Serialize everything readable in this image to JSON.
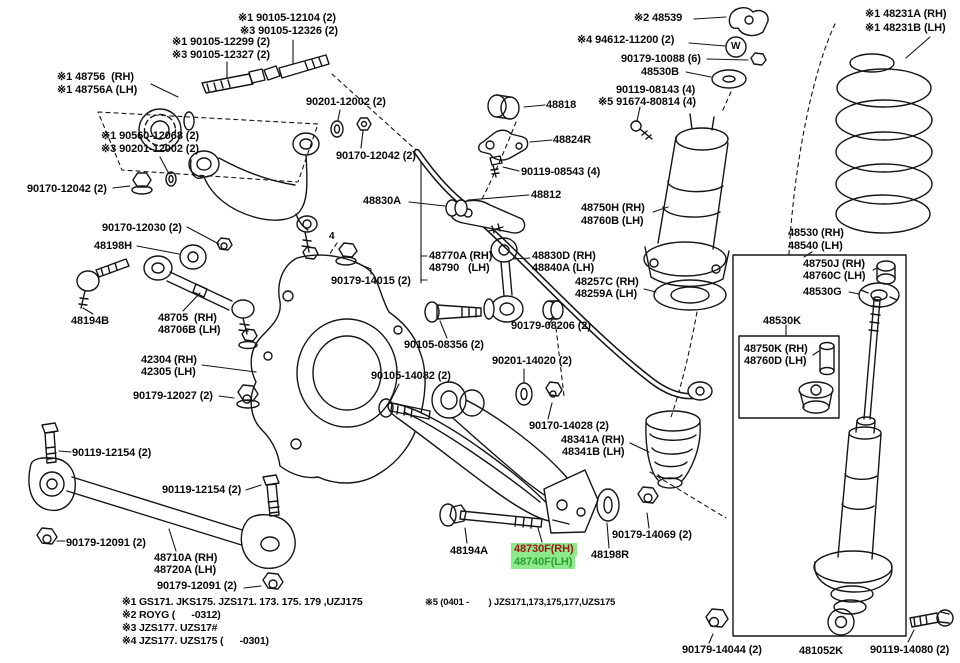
{
  "page": {
    "background": "#ffffff",
    "ink": "#151515",
    "kind": "exploded-parts-diagram",
    "subject": "rear suspension"
  },
  "highlight": {
    "bg": "#8ce98c",
    "rh_text": "#a11616",
    "lh_text": "#2f9e2f"
  },
  "labels": [
    {
      "name": "label-90105-12104",
      "text": "※1 90105-12104 (2)",
      "x": 238,
      "y": 12
    },
    {
      "name": "label-90105-12326",
      "text": "※3 90105-12326 (2)",
      "x": 240,
      "y": 25
    },
    {
      "name": "label-90105-12299",
      "text": "※1 90105-12299 (2)",
      "x": 172,
      "y": 36
    },
    {
      "name": "label-90105-12327",
      "text": "※3 90105-12327 (2)",
      "x": 172,
      "y": 49
    },
    {
      "name": "label-48756-rh",
      "text": "※1 48756  (RH)",
      "x": 57,
      "y": 71
    },
    {
      "name": "label-48756a-lh",
      "text": "※1 48756A (LH)",
      "x": 57,
      "y": 84
    },
    {
      "name": "label-90201-12002-top",
      "text": "90201-12002 (2)",
      "x": 306,
      "y": 96
    },
    {
      "name": "label-90560-12068",
      "text": "※1 90560-12068 (2)",
      "x": 101,
      "y": 130
    },
    {
      "name": "label-90201-12002-left",
      "text": "※3 90201-12002 (2)",
      "x": 101,
      "y": 143
    },
    {
      "name": "label-90170-12042-left",
      "text": "90170-12042 (2)",
      "x": 27,
      "y": 183
    },
    {
      "name": "label-90170-12042-center",
      "text": "90170-12042 (2)",
      "x": 336,
      "y": 150
    },
    {
      "name": "label-48818",
      "text": "48818",
      "x": 546,
      "y": 99
    },
    {
      "name": "label-48824r",
      "text": "48824R",
      "x": 553,
      "y": 134
    },
    {
      "name": "label-90119-08543",
      "text": "90119-08543 (4)",
      "x": 521,
      "y": 166
    },
    {
      "name": "label-48812",
      "text": "48812",
      "x": 531,
      "y": 189
    },
    {
      "name": "label-48830a",
      "text": "48830A",
      "x": 363,
      "y": 195
    },
    {
      "name": "label-48539",
      "text": "※2 48539",
      "x": 634,
      "y": 12
    },
    {
      "name": "label-94612-11200",
      "text": "※4 94612-11200 (2)",
      "x": 577,
      "y": 34
    },
    {
      "name": "label-90179-10088",
      "text": "90179-10088 (6)",
      "x": 621,
      "y": 53
    },
    {
      "name": "label-48530b",
      "text": "48530B",
      "x": 641,
      "y": 66
    },
    {
      "name": "label-90119-08143",
      "text": "90119-08143 (4)",
      "x": 616,
      "y": 84
    },
    {
      "name": "label-91674-80814",
      "text": "※5 91674-80814 (4)",
      "x": 598,
      "y": 96
    },
    {
      "name": "label-48231a-rh",
      "text": "※1 48231A (RH)",
      "x": 865,
      "y": 8
    },
    {
      "name": "label-48231b-lh",
      "text": "※1 48231B (LH)",
      "x": 865,
      "y": 22
    },
    {
      "name": "label-48750h-rh",
      "text": "48750H (RH)",
      "x": 581,
      "y": 202
    },
    {
      "name": "label-48760b-lh",
      "text": "48760B (LH)",
      "x": 581,
      "y": 215
    },
    {
      "name": "label-48530-rh",
      "text": "48530 (RH)",
      "x": 788,
      "y": 227
    },
    {
      "name": "label-48540-lh",
      "text": "48540 (LH)",
      "x": 788,
      "y": 240
    },
    {
      "name": "label-48750j-rh",
      "text": "48750J (RH)",
      "x": 803,
      "y": 258
    },
    {
      "name": "label-48760c-lh",
      "text": "48760C (LH)",
      "x": 803,
      "y": 270
    },
    {
      "name": "label-48530g",
      "text": "48530G",
      "x": 803,
      "y": 286
    },
    {
      "name": "label-48530k",
      "text": "48530K",
      "x": 763,
      "y": 315
    },
    {
      "name": "label-48750k-rh",
      "text": "48750K (RH)",
      "x": 744,
      "y": 343
    },
    {
      "name": "label-48760d-lh",
      "text": "48760D (LH)",
      "x": 744,
      "y": 355
    },
    {
      "name": "label-90170-12030",
      "text": "90170-12030 (2)",
      "x": 102,
      "y": 222
    },
    {
      "name": "label-48198h",
      "text": "48198H",
      "x": 94,
      "y": 240
    },
    {
      "name": "label-90179-14015",
      "text": "90179-14015 (2)",
      "x": 331,
      "y": 275
    },
    {
      "name": "label-48770a-rh",
      "text": "48770A (RH)",
      "x": 429,
      "y": 250
    },
    {
      "name": "label-48790-lh",
      "text": "48790   (LH)",
      "x": 429,
      "y": 262
    },
    {
      "name": "label-48830d-rh",
      "text": "48830D (RH)",
      "x": 532,
      "y": 250
    },
    {
      "name": "label-48840a-lh",
      "text": "48840A (LH)",
      "x": 532,
      "y": 262
    },
    {
      "name": "label-48257c-rh",
      "text": "48257C (RH)",
      "x": 575,
      "y": 276
    },
    {
      "name": "label-48259a-lh",
      "text": "48259A (LH)",
      "x": 575,
      "y": 288
    },
    {
      "name": "label-48194b",
      "text": "48194B",
      "x": 71,
      "y": 315
    },
    {
      "name": "label-48705-rh",
      "text": "48705  (RH)",
      "x": 158,
      "y": 312
    },
    {
      "name": "label-48706b-lh",
      "text": "48706B (LH)",
      "x": 158,
      "y": 324
    },
    {
      "name": "label-42304-rh",
      "text": "42304 (RH)",
      "x": 141,
      "y": 354
    },
    {
      "name": "label-42305-lh",
      "text": "42305 (LH)",
      "x": 141,
      "y": 366
    },
    {
      "name": "label-90179-12027",
      "text": "90179-12027 (2)",
      "x": 133,
      "y": 390
    },
    {
      "name": "label-90105-08356",
      "text": "90105-08356 (2)",
      "x": 404,
      "y": 339
    },
    {
      "name": "label-90201-14020",
      "text": "90201-14020 (2)",
      "x": 492,
      "y": 355
    },
    {
      "name": "label-90105-14082",
      "text": "90105-14082 (2)",
      "x": 371,
      "y": 370
    },
    {
      "name": "label-90179-08206",
      "text": "90179-08206 (2)",
      "x": 511,
      "y": 320
    },
    {
      "name": "label-90170-14028",
      "text": "90170-14028 (2)",
      "x": 529,
      "y": 420
    },
    {
      "name": "label-48341a-rh",
      "text": "48341A (RH)",
      "x": 561,
      "y": 434
    },
    {
      "name": "label-48341b-lh",
      "text": "48341B (LH)",
      "x": 562,
      "y": 446
    },
    {
      "name": "label-90119-12154-a",
      "text": "90119-12154 (2)",
      "x": 72,
      "y": 447
    },
    {
      "name": "label-90119-12154-b",
      "text": "90119-12154 (2)",
      "x": 162,
      "y": 484
    },
    {
      "name": "label-90179-12091-a",
      "text": "90179-12091 (2)",
      "x": 66,
      "y": 537
    },
    {
      "name": "label-48710a-rh",
      "text": "48710A (RH)",
      "x": 154,
      "y": 552
    },
    {
      "name": "label-48720a-lh",
      "text": "48720A (LH)",
      "x": 154,
      "y": 564
    },
    {
      "name": "label-90179-12091-b",
      "text": "90179-12091 (2)",
      "x": 157,
      "y": 580
    },
    {
      "name": "label-48194a",
      "text": "48194A",
      "x": 450,
      "y": 545
    },
    {
      "name": "label-48730f-rh",
      "text": "48730F(RH)",
      "x": 511,
      "y": 543,
      "cls": "hl-rh"
    },
    {
      "name": "label-48740f-lh",
      "text": "48740F(LH)",
      "x": 511,
      "y": 556,
      "cls": "hl-lh"
    },
    {
      "name": "label-48198r",
      "text": "48198R",
      "x": 591,
      "y": 549
    },
    {
      "name": "label-90179-14069",
      "text": "90179-14069 (2)",
      "x": 612,
      "y": 529
    },
    {
      "name": "label-90179-14044",
      "text": "90179-14044 (2)",
      "x": 682,
      "y": 644
    },
    {
      "name": "label-481052k",
      "text": "481052K",
      "x": 799,
      "y": 645
    },
    {
      "name": "label-90119-14080",
      "text": "90119-14080 (2)",
      "x": 870,
      "y": 644
    },
    {
      "name": "note-1",
      "text": "※1 GS171. JKS175. JZS171. 173. 175. 179 ,UZJ175",
      "x": 122,
      "y": 597,
      "cls": "note",
      "click": false
    },
    {
      "name": "note-5",
      "text": "※5 (0401 -        ) JZS171,173,175,177,UZS175",
      "x": 425,
      "y": 598,
      "cls": "note small",
      "click": false
    },
    {
      "name": "note-2",
      "text": "※2 ROYG (      -0312)",
      "x": 122,
      "y": 610,
      "cls": "note",
      "click": false
    },
    {
      "name": "note-3",
      "text": "※3 JZS177. UZS17#",
      "x": 122,
      "y": 623,
      "cls": "note",
      "click": false
    },
    {
      "name": "note-4",
      "text": "※4 JZS177. UZS175 (      -0301)",
      "x": 122,
      "y": 636,
      "cls": "note",
      "click": false
    },
    {
      "name": "mark-w",
      "text": "W",
      "x": 731,
      "y": 41,
      "cls": "mark",
      "click": false
    },
    {
      "name": "mark-4",
      "text": "4",
      "x": 329,
      "y": 231,
      "cls": "mark",
      "click": false
    }
  ]
}
